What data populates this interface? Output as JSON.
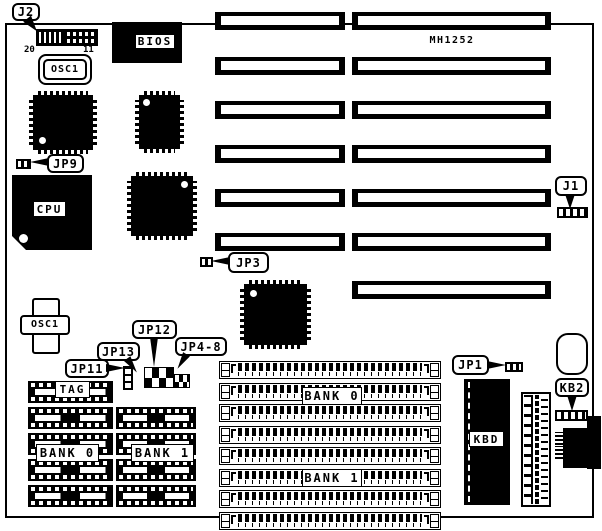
{
  "board": {
    "model": "MH1252"
  },
  "callouts": {
    "j2": "J2",
    "jp9": "JP9",
    "jp3": "JP3",
    "j1": "J1",
    "jp12": "JP12",
    "jp13": "JP13",
    "jp4_8": "JP4-8",
    "jp11": "JP11",
    "jp1": "JP1",
    "kb2": "KB2"
  },
  "chips": {
    "bios": "BIOS",
    "cpu": "CPU",
    "kbd": "KBD",
    "tag": "TAG"
  },
  "oscillators": {
    "top": "OSC1",
    "bottom": "OSC1"
  },
  "memory_banks": {
    "dip_bank0": "BANK 0",
    "dip_bank1": "BANK 1",
    "simm_bank0": "BANK 0",
    "simm_bank1": "BANK 1"
  },
  "j2_pins": {
    "left": "20",
    "right": "11"
  },
  "counts": {
    "isa_slots_left": 6,
    "isa_slots_right": 7,
    "simm_sockets": 8,
    "dip_rows_bank0": 5,
    "dip_rows_bank1": 4
  },
  "colors": {
    "ink": "#000000",
    "paper": "#ffffff"
  }
}
